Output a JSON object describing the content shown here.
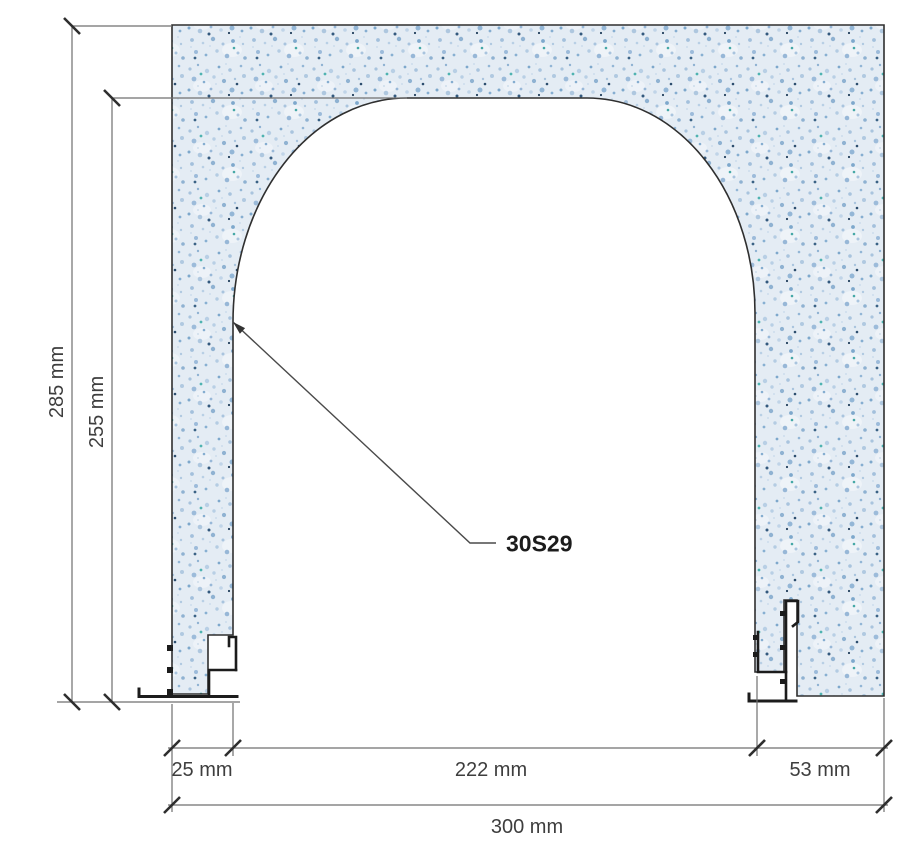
{
  "labels": {
    "part": "30S29"
  },
  "dimensions": {
    "total_height": "285 mm",
    "opening_height": "255 mm",
    "left_jamb": "25 mm",
    "opening_width": "222 mm",
    "right_jamb": "53 mm",
    "total_width": "300 mm"
  },
  "colors": {
    "material_fill": "#e4ecf4",
    "speckle": "#9cbbda",
    "outline": "#2f2f2f",
    "profile_steel": "#1c1c1c",
    "dim_lines": "#6f6f6f",
    "dim_ticks": "#2e2e2e",
    "dim_text": "#3e3e3e",
    "label_text": "#1c1c1c"
  }
}
